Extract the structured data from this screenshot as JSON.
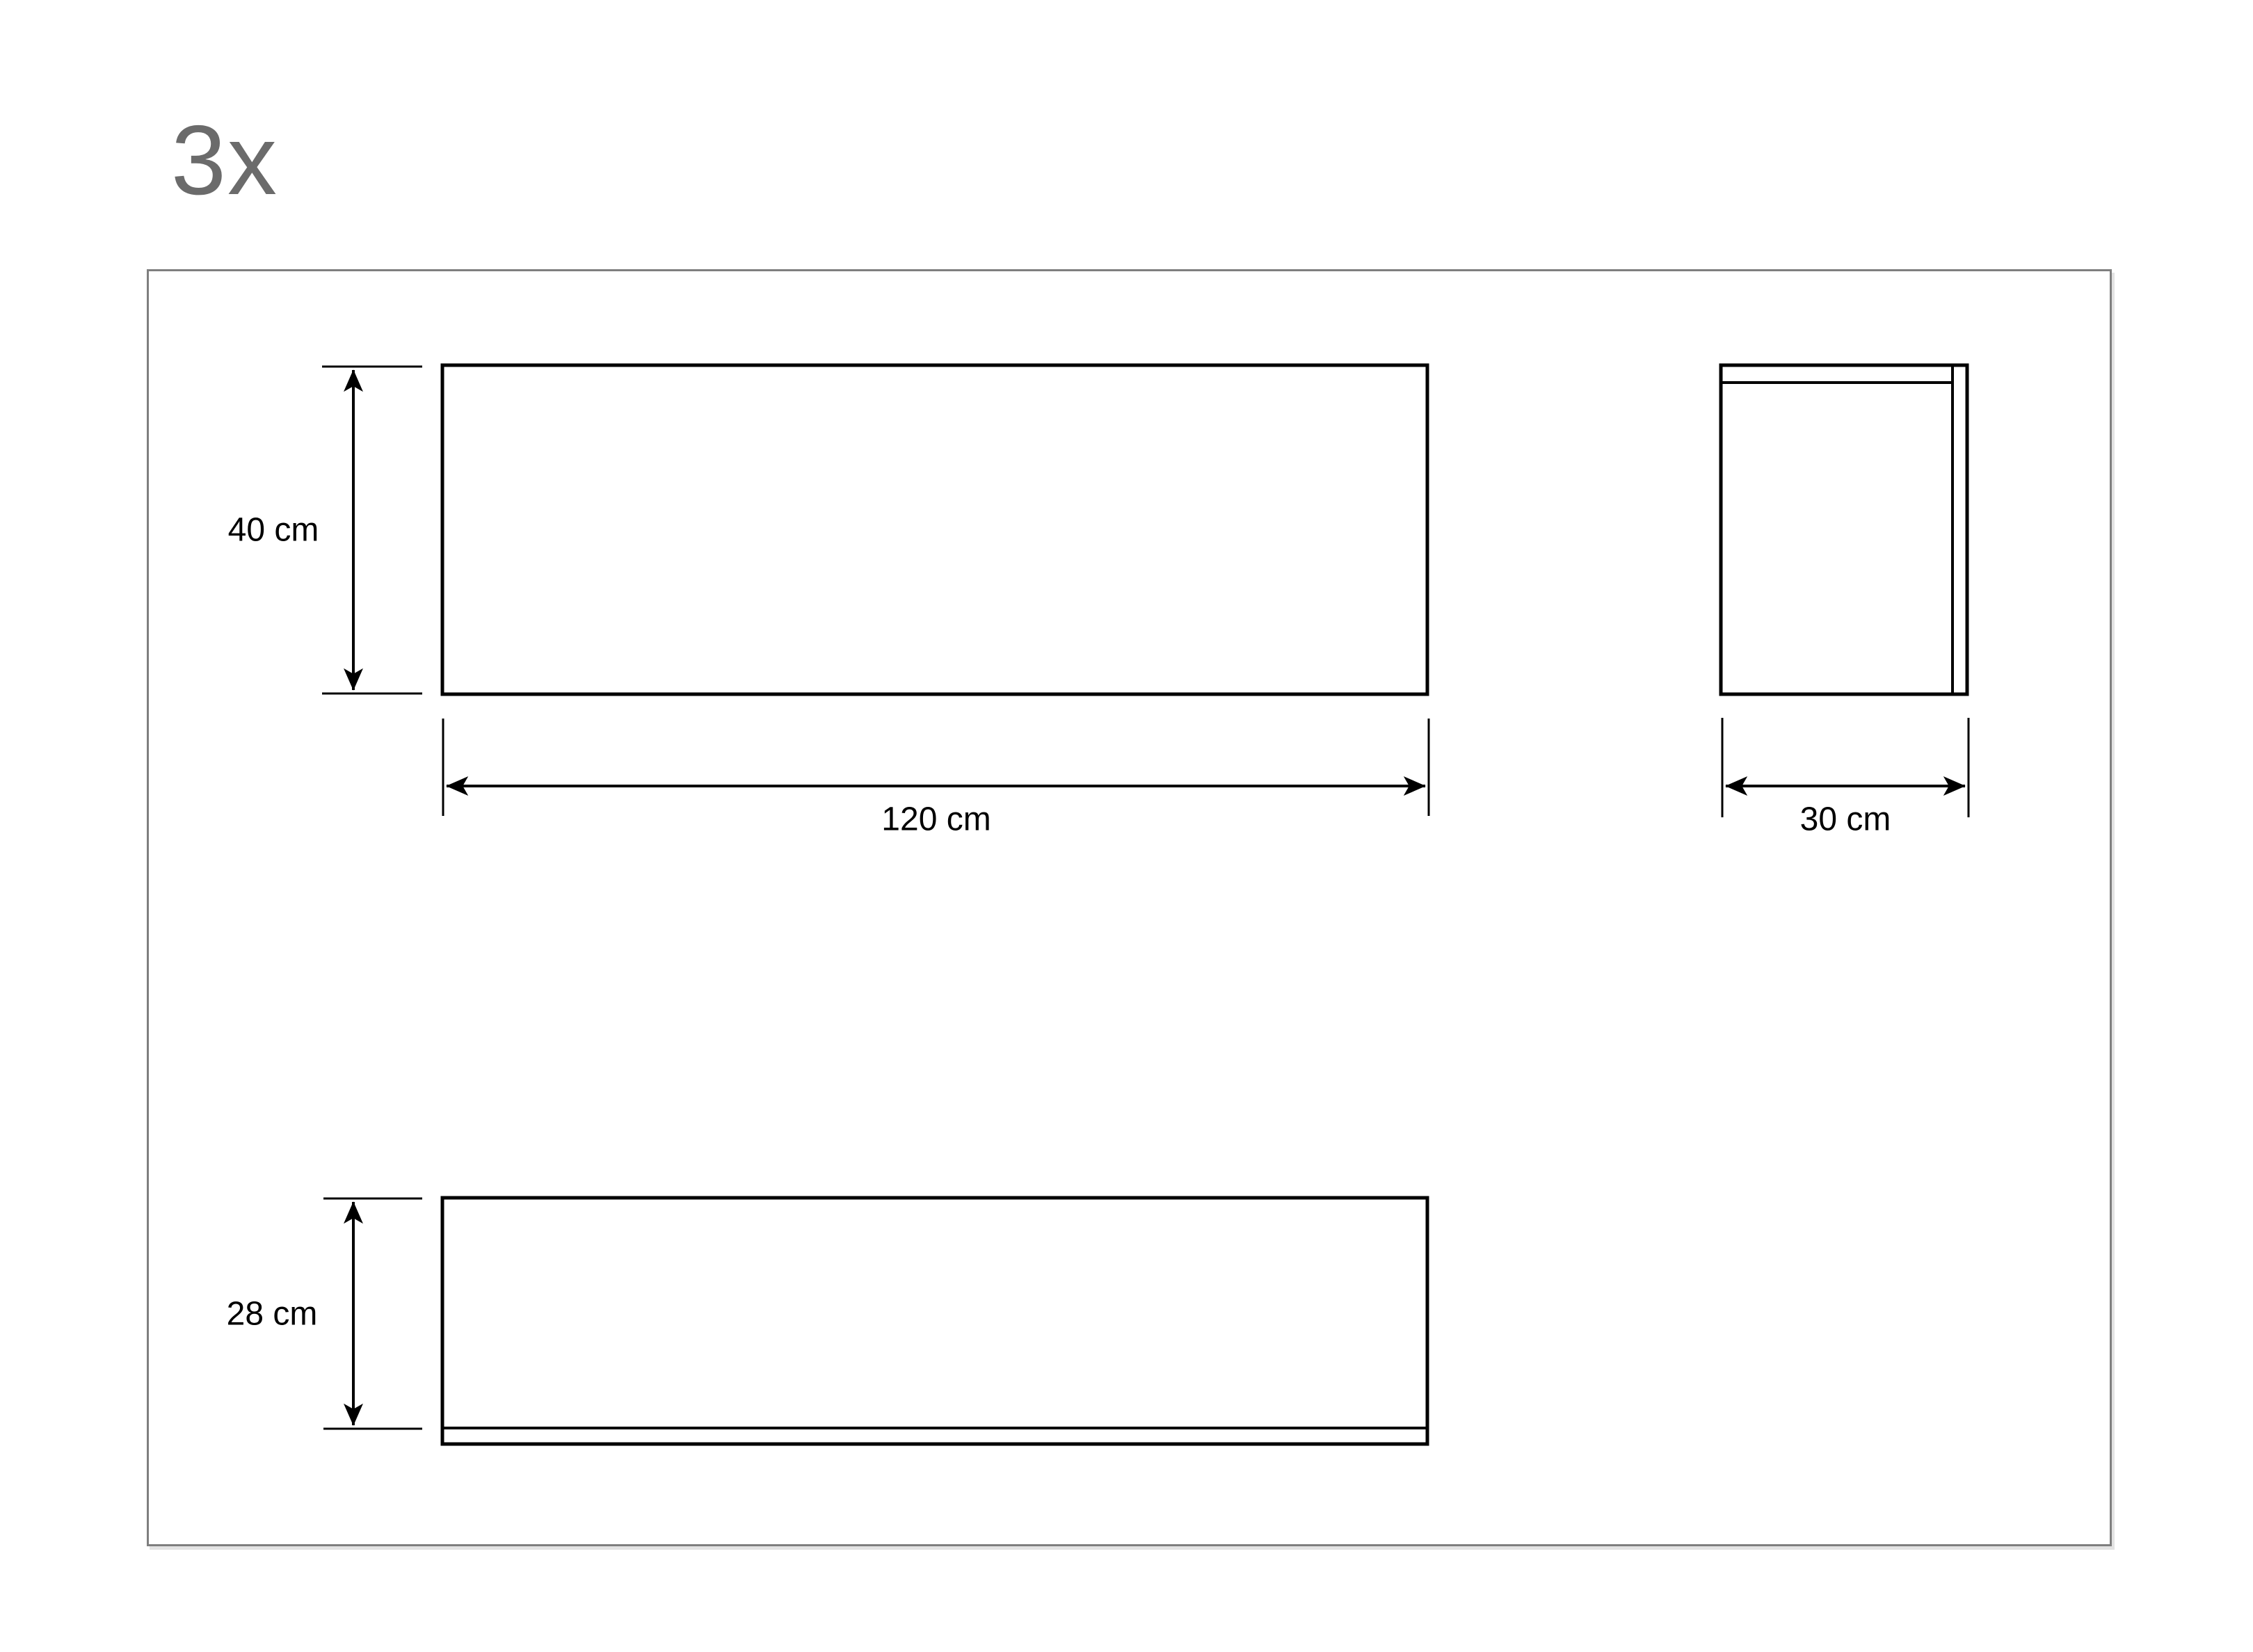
{
  "quantity": {
    "label": "3x",
    "count": 3
  },
  "colors": {
    "background": "#ffffff",
    "frame_border": "#7f7f7f",
    "drawing_line": "#000000",
    "dimension_text": "#000000",
    "quantity_text": "#6b6b6b"
  },
  "views": {
    "front_view": {
      "height_dimension": {
        "value": 40,
        "unit": "cm",
        "label": "40 cm"
      },
      "width_dimension": {
        "value": 120,
        "unit": "cm",
        "label": "120 cm"
      }
    },
    "side_view": {
      "width_dimension": {
        "value": 30,
        "unit": "cm",
        "label": "30 cm"
      }
    },
    "top_view": {
      "depth_dimension": {
        "value": 28,
        "unit": "cm",
        "label": "28 cm"
      }
    }
  }
}
